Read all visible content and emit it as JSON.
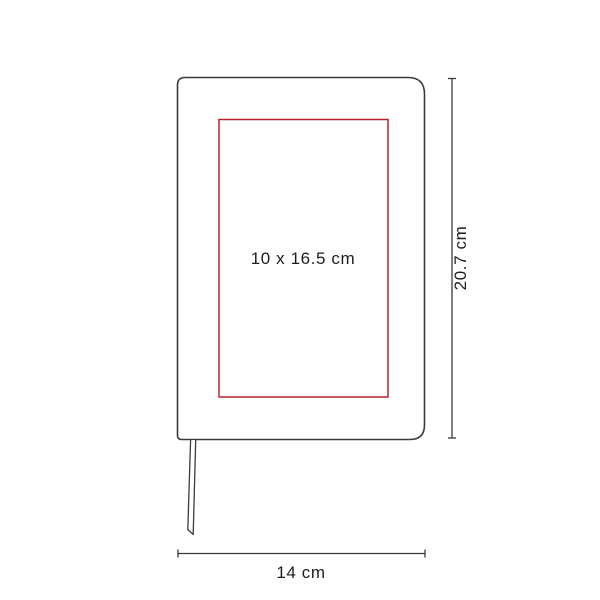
{
  "diagram": {
    "type": "product-dimension-diagram",
    "product": "notebook with bookmark ribbon",
    "print_area_label": "10 x 16.5 cm",
    "height_label": "20.7 cm",
    "width_label": "14 cm"
  },
  "colors": {
    "background": "#ffffff",
    "outline": "#3b3b3b",
    "print_area": "#b5232e",
    "text": "#1d1d1f"
  }
}
